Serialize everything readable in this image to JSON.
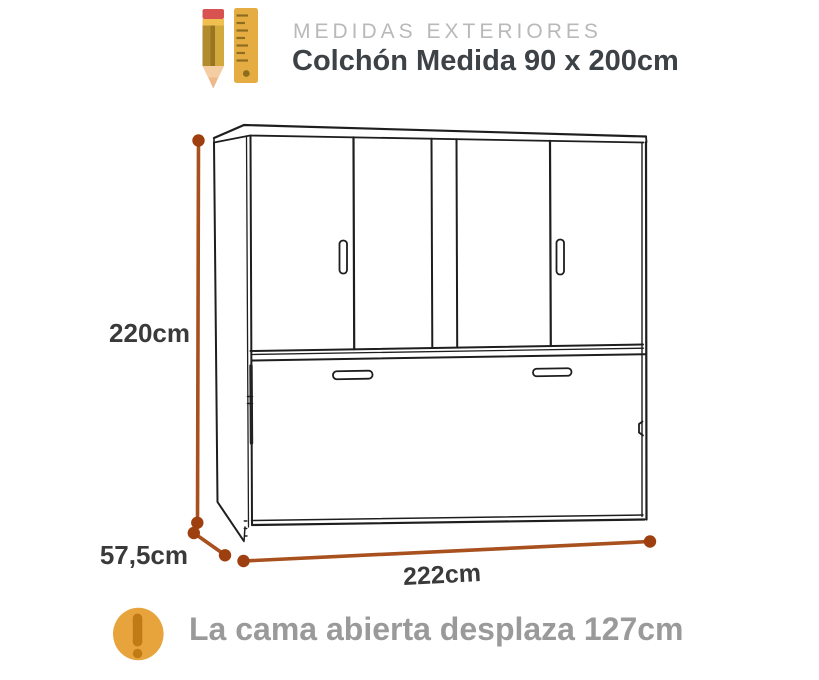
{
  "header": {
    "title": "MEDIDAS EXTERIORES",
    "subtitle": "Colchón Medida 90 x 200cm"
  },
  "diagram": {
    "type": "furniture-dimension-line-drawing",
    "height_label": "220cm",
    "depth_label": "57,5cm",
    "width_label": "222cm"
  },
  "note": {
    "text": "La cama abierta desplaza 127cm"
  },
  "colors": {
    "dimension_line": "#A8501E",
    "dimension_dot": "#9E3F10",
    "accent_orange": "#E7A33C",
    "exclamation_mark": "#C07B16",
    "title_gray": "#B9B9B9",
    "subtitle_dark": "#3D4247",
    "label_dark": "#3A3A3A",
    "note_gray": "#9A9A9A",
    "outline_black": "#1E1E1E"
  }
}
